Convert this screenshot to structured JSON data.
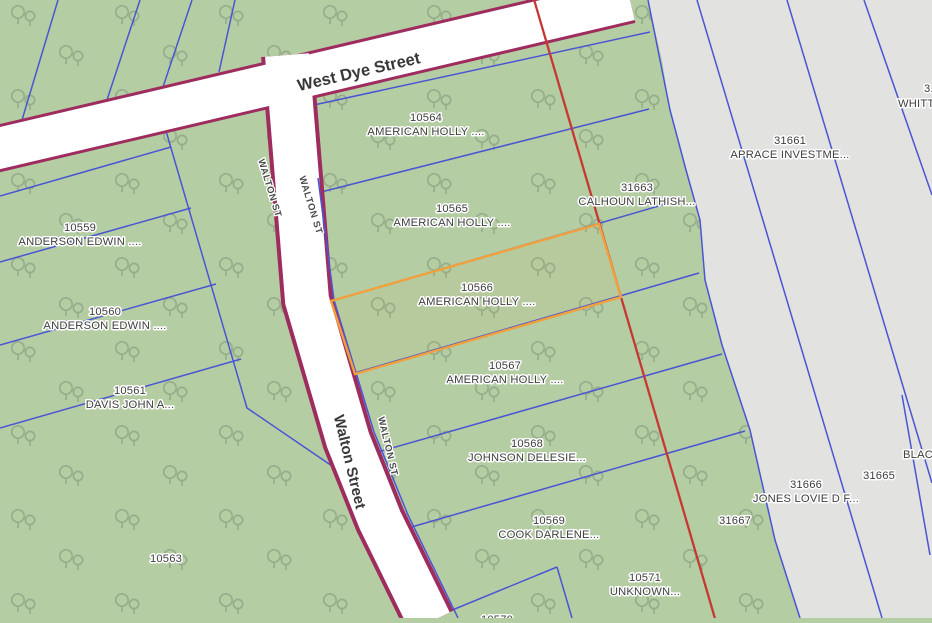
{
  "streets": {
    "west_dye": "West Dye Street",
    "walton": "Walton Street",
    "walton_short_1": "WALTON ST",
    "walton_short_2": "WALTON ST",
    "walton_short_3": "WALTON ST"
  },
  "selected_parcel": "10566",
  "parcels": [
    {
      "id": "10564",
      "owner": "AMERICAN HOLLY ...."
    },
    {
      "id": "10565",
      "owner": "AMERICAN HOLLY ...."
    },
    {
      "id": "10566",
      "owner": "AMERICAN HOLLY ...."
    },
    {
      "id": "10567",
      "owner": "AMERICAN HOLLY ...."
    },
    {
      "id": "10568",
      "owner": "JOHNSON DELESIE..."
    },
    {
      "id": "10569",
      "owner": "COOK DARLENE..."
    },
    {
      "id": "10571",
      "owner": "UNKNOWN..."
    },
    {
      "id": "10570",
      "owner": ""
    },
    {
      "id": "10559",
      "owner": "ANDERSON EDWIN ...."
    },
    {
      "id": "10560",
      "owner": "ANDERSON EDWIN ...."
    },
    {
      "id": "10561",
      "owner": "DAVIS JOHN A..."
    },
    {
      "id": "10563",
      "owner": ""
    },
    {
      "id": "31663",
      "owner": "CALHOUN LATHISH..."
    },
    {
      "id": "31661",
      "owner": "APRACE INVESTME..."
    },
    {
      "id": "31666",
      "owner": "JONES LOVIE D F..."
    },
    {
      "id": "31665",
      "owner": ""
    },
    {
      "id": "31667",
      "owner": ""
    },
    {
      "id": "",
      "owner": "BLAC..."
    },
    {
      "id": "3...",
      "owner": "WHITT..."
    }
  ],
  "colors": {
    "landcover_green": "#b5cda3",
    "landcover_gray": "#e2e2e0",
    "tree_icon": "#8da585",
    "parcel_line_blue": "#4a55d4",
    "road_fill": "#ffffff",
    "road_casing_maroon": "#9e2c5e",
    "boundary_red": "#c63832",
    "selection_orange": "#f0a03c",
    "label_text": "#3e3e3e",
    "label_halo": "#ffffff"
  },
  "icons": {
    "tree_icon": "paired outline trees landcover symbol"
  }
}
